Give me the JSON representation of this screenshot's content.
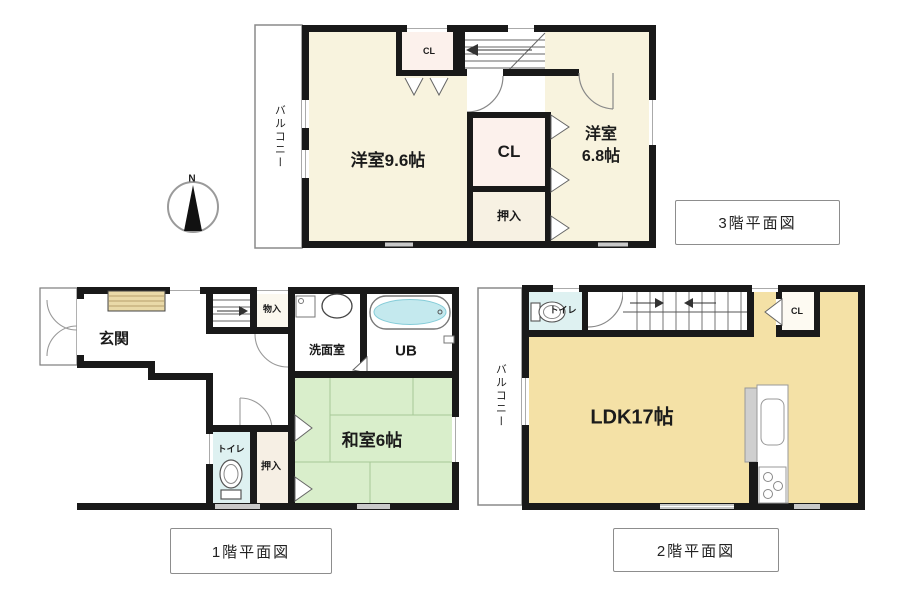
{
  "compass": {
    "north_label": "N"
  },
  "floor3": {
    "caption": "3階平面図",
    "rooms": {
      "bedroom_main": "洋室9.6帖",
      "bedroom_second_line1": "洋室",
      "bedroom_second_line2": "6.8帖",
      "closet_top": "CL",
      "closet_mid": "CL",
      "oshiire": "押入",
      "balcony": "バルコニー"
    }
  },
  "floor1": {
    "caption": "1階平面図",
    "rooms": {
      "genkan": "玄関",
      "monoire": "物入",
      "senmenshitsu": "洗面室",
      "unit_bath": "UB",
      "washitsu": "和室6帖",
      "toilet": "トイレ",
      "oshiire": "押入"
    }
  },
  "floor2": {
    "caption": "2階平面図",
    "rooms": {
      "ldk": "LDK17帖",
      "toilet": "トイレ",
      "closet": "CL",
      "balcony": "バルコニー"
    }
  },
  "colors": {
    "wall": "#191919",
    "bedroom_cream": "#f8f3de",
    "closet_pink": "#fcf1ec",
    "oshiire_cream": "#f7f1e3",
    "ldk_tan": "#f4e1a6",
    "tatami_green": "#d9eecb",
    "toilet_cyan": "#def1f1",
    "cabinet_tan": "#e9d9a8",
    "bath_water": "#c4e9ee"
  }
}
